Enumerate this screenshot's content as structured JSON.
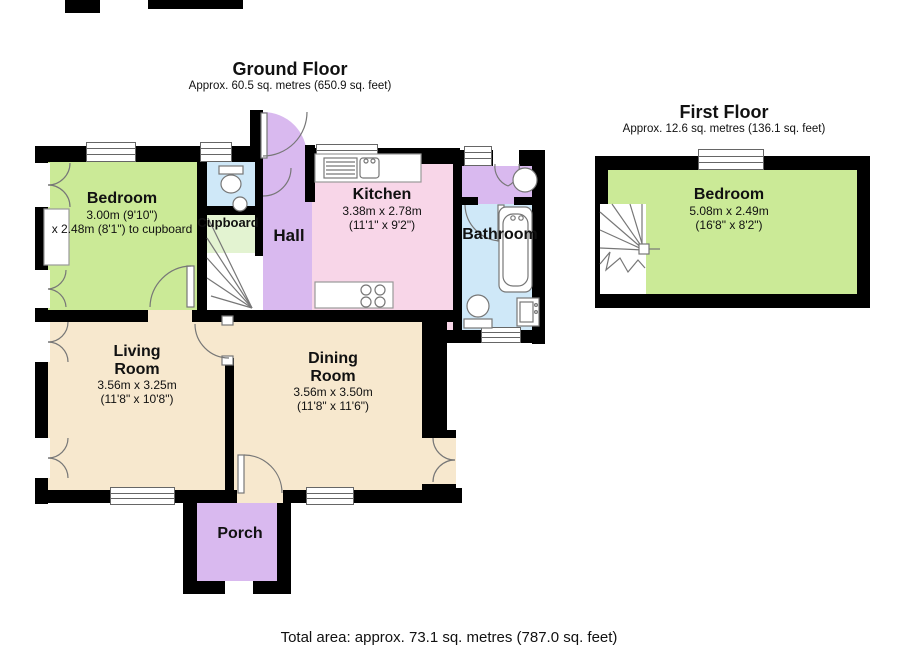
{
  "ground_floor": {
    "title": "Ground Floor",
    "area": "Approx. 60.5 sq. metres (650.9 sq. feet)",
    "rooms": {
      "bedroom": {
        "name": "Bedroom",
        "dim1": "3.00m (9'10\")",
        "dim2": "x 2.48m (8'1\") to cupboard"
      },
      "cupboard": {
        "name": "Cupboard"
      },
      "hall": {
        "name": "Hall"
      },
      "kitchen": {
        "name": "Kitchen",
        "dim1": "3.38m x 2.78m",
        "dim2": "(11'1\" x 9'2\")"
      },
      "bathroom": {
        "name": "Bathroom"
      },
      "living_room": {
        "name": "Living Room",
        "dim1": "3.56m x 3.25m",
        "dim2": "(11'8\" x 10'8\")"
      },
      "dining_room": {
        "name": "Dining Room",
        "dim1": "3.56m x 3.50m",
        "dim2": "(11'8\" x 11'6\")"
      },
      "porch": {
        "name": "Porch"
      }
    }
  },
  "first_floor": {
    "title": "First Floor",
    "area": "Approx. 12.6 sq. metres (136.1 sq. feet)",
    "rooms": {
      "bedroom": {
        "name": "Bedroom",
        "dim1": "5.08m x 2.49m",
        "dim2": "(16'8\" x 8'2\")"
      }
    }
  },
  "footer": {
    "total_area": "Total area: approx. 73.1 sq. metres (787.0 sq. feet)"
  },
  "colors": {
    "wall": "#000000",
    "bedroom_green": "#CBEA97",
    "pale_green": "#E3F3D1",
    "kitchen_pink": "#F8D6E8",
    "hall_lavender": "#D9B9EF",
    "bath_blue": "#CFE8F8",
    "floor_cream": "#F7E8CE",
    "fixture_gray": "#777777",
    "text": "#111111"
  }
}
